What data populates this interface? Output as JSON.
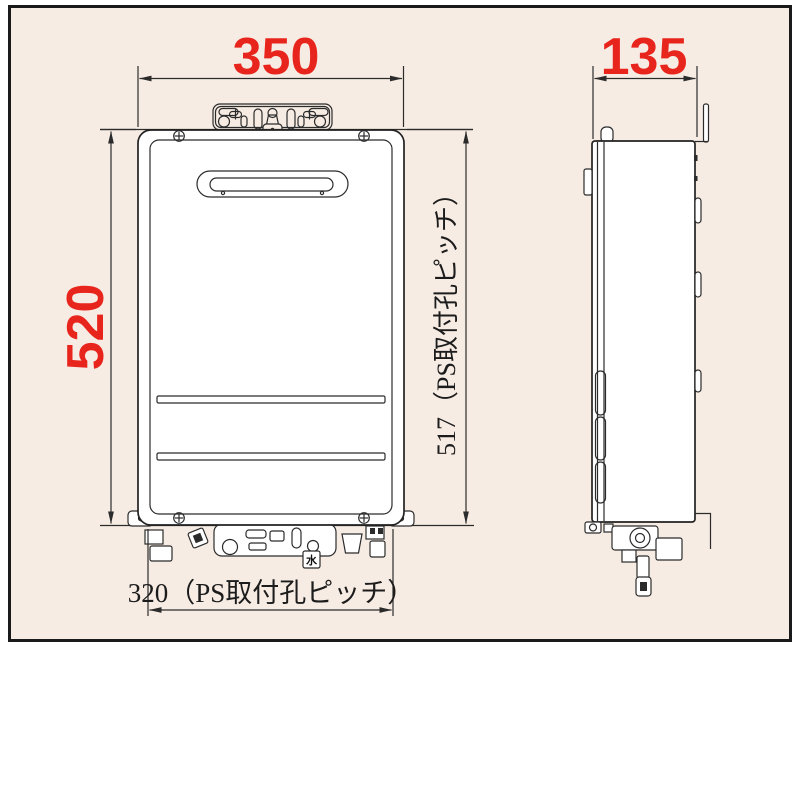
{
  "panel": {
    "background_color": "#f7ece4",
    "border_color": "#1a1a1a"
  },
  "colors": {
    "dimension_red": "#e8251d",
    "line_color": "#2b2b2b",
    "unit_body_fill": "#ffffff"
  },
  "dimensions": {
    "width_front": "350",
    "depth_side": "135",
    "height_front": "520",
    "pitch_vertical": "517（PS取付孔ピッチ）",
    "pitch_horizontal": "320（PS取付孔ピッチ）"
  },
  "labels": {
    "water_tag": "水"
  },
  "views": {
    "front": "front-view-water-heater",
    "side": "side-view-water-heater"
  }
}
